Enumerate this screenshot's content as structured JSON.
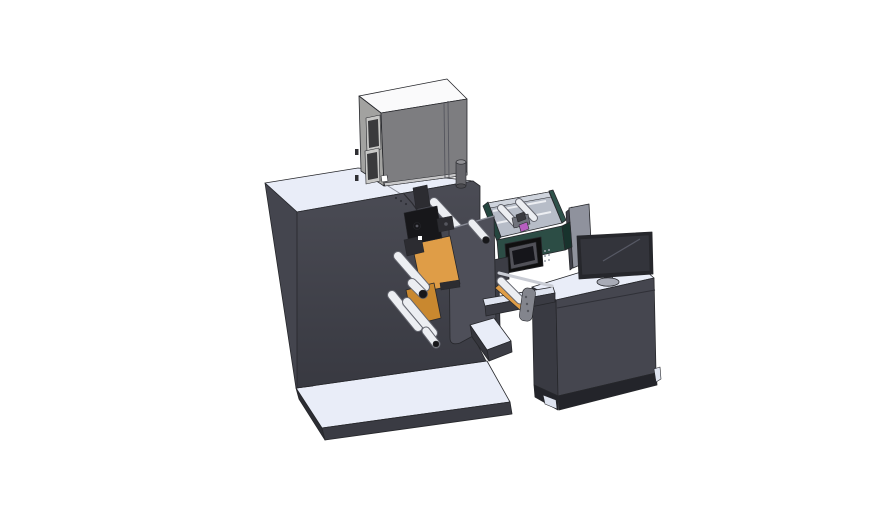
{
  "colors": {
    "background": "#ffffff",
    "edge": "#26272b",
    "surface_light": "#e9edf8",
    "surface_light2": "#dfe4f0",
    "slab_front": "#3a3b43",
    "slab_side": "#2c2d33",
    "cabinet_front_top": "#4b4c55",
    "cabinet_front_bottom": "#383941",
    "cabinet_left": "#44454e",
    "desk_front": "#45464f",
    "desk_left": "#393a42",
    "desk_plinth": "#23242a",
    "seam": "#2f3037",
    "graybox_top": "#fafafb",
    "graybox_left": "#a2a2a0",
    "graybox_front": "#7d7d80",
    "graybox_frame": "#c8c8c6",
    "graybox_glass": "#3a3a3c",
    "graybox_strip": "#c9c9cb",
    "graybox_tab": "#2f2f33",
    "cylinder_body": "#66666b",
    "cylinder_top": "#909094",
    "cylinder_bottom": "#4a4a4f",
    "turret": "#4e4f59",
    "turret_top": "#8b8e99",
    "orange": "#df9d47",
    "orange_dark": "#c9882f",
    "roller_outline": "#63656e",
    "roller_body": "#eceef2",
    "mech_dark": "#17171a",
    "mech_mid": "#2c2c31",
    "mech_light": "#55565e",
    "white": "#ffffff",
    "green_wall": "#2e524a",
    "green_wall_dark": "#24453e",
    "green_front": "#2c4d45",
    "green_side": "#18332d",
    "green_interior": "#b7bdc8",
    "green_interior_light": "#cfd4dd",
    "green_mech": "#70737c",
    "green_mech_dark": "#3a3b40",
    "magenta": "#b85fc0",
    "panel_black": "#101010",
    "screen_outer": "#515158",
    "screen_inner": "#15151a",
    "button_dot": "#9aa0ab",
    "divider_gray": "#8f929d",
    "divider_dark": "#40414a",
    "monitor_frame": "#26272c",
    "monitor_screen": "#33343b",
    "monitor_reflect": "#565864",
    "monitor_stand": "#8b8e99",
    "monitor_base": "#a8abb6",
    "handle": "#83858d",
    "handle_dot": "#55575e",
    "silver_bar": "#c9ccd4",
    "tower": "#3c3d45",
    "step_front": "#3c3d45",
    "step_side": "#34353c"
  }
}
